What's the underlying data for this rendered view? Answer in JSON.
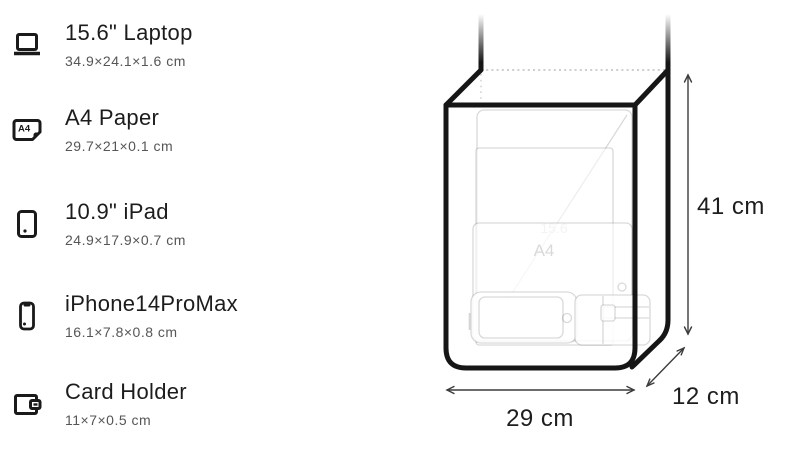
{
  "items": [
    {
      "icon": "laptop-icon",
      "title": "15.6\" Laptop",
      "dims": "34.9×24.1×1.6 cm"
    },
    {
      "icon": "a4-paper-icon",
      "title": "A4 Paper",
      "dims": "29.7×21×0.1 cm"
    },
    {
      "icon": "ipad-icon",
      "title": "10.9\" iPad",
      "dims": "24.9×17.9×0.7 cm"
    },
    {
      "icon": "iphone-icon",
      "title": "iPhone14ProMax",
      "dims": "16.1×7.8×0.8 cm"
    },
    {
      "icon": "card-holder-icon",
      "title": "Card Holder",
      "dims": "11×7×0.5 cm"
    }
  ],
  "icons": {
    "a4_label": "A4"
  },
  "diagram": {
    "height_label": "41 cm",
    "width_label": "29 cm",
    "depth_label": "12 cm",
    "ghost_laptop_label": "15.6",
    "ghost_a4_label": "A4",
    "outline_color": "#161616",
    "ghost_line_color": "#d9d9d9",
    "arrow_color": "#3c3c3c"
  }
}
